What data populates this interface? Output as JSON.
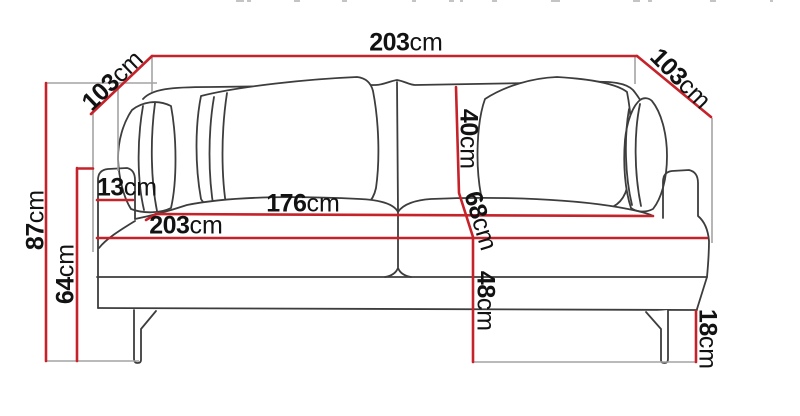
{
  "diagram": {
    "subject": "Sofa dimension diagram",
    "unit": "cm"
  },
  "colors": {
    "dimension_line": "#c6222a",
    "extension_line": "#a3a3a3",
    "sofa_outline": "#3d3d3d",
    "label_text": "#121212",
    "background": "#ffffff"
  },
  "dims": {
    "overall_width_top": {
      "value": "203",
      "unit": "cm"
    },
    "depth_left": {
      "value": "103",
      "unit": "cm"
    },
    "depth_right": {
      "value": "103",
      "unit": "cm"
    },
    "overall_height": {
      "value": "87",
      "unit": "cm"
    },
    "armrest_height": {
      "value": "64",
      "unit": "cm"
    },
    "armrest_width": {
      "value": "13",
      "unit": "cm"
    },
    "seat_width": {
      "value": "176",
      "unit": "cm"
    },
    "front_width": {
      "value": "203",
      "unit": "cm"
    },
    "back_cushion_height": {
      "value": "40",
      "unit": "cm"
    },
    "seat_depth": {
      "value": "68",
      "unit": "cm"
    },
    "seat_height": {
      "value": "48",
      "unit": "cm"
    },
    "leg_height": {
      "value": "18",
      "unit": "cm"
    }
  }
}
